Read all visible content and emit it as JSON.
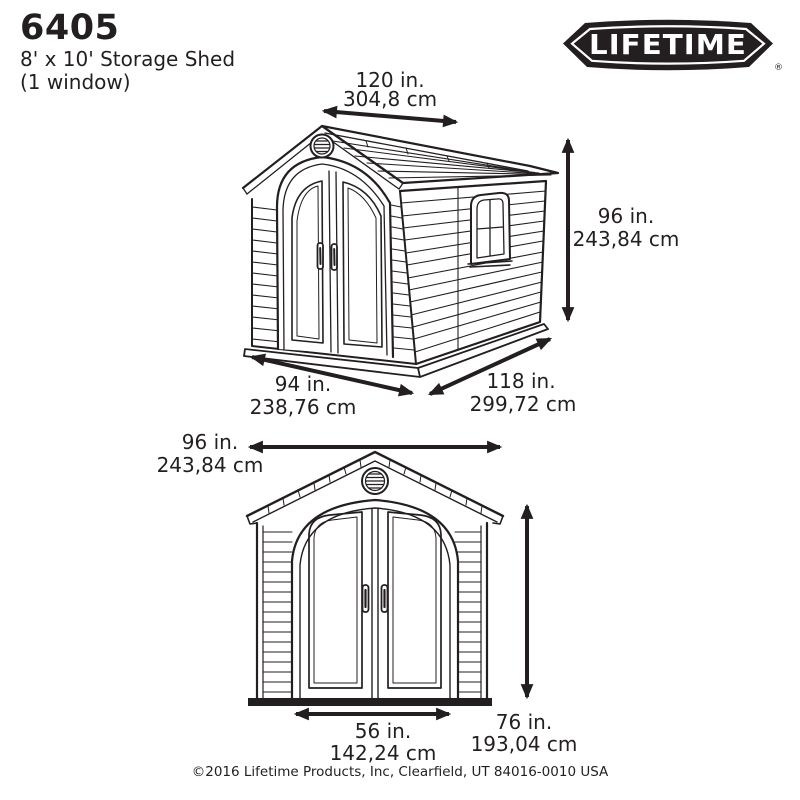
{
  "page": {
    "background": "#ffffff",
    "ink": "#231f20"
  },
  "header": {
    "model": "6405",
    "product": "8' x 10' Storage Shed",
    "variant": "(1 window)",
    "logo_text": "LIFETIME",
    "registered_mark": "®"
  },
  "diagrams": {
    "perspective": {
      "roof_width": {
        "in": "120 in.",
        "cm": "304,8 cm"
      },
      "height": {
        "in": "96 in.",
        "cm": "243,84 cm"
      },
      "front_width": {
        "in": "94 in.",
        "cm": "238,76 cm"
      },
      "depth": {
        "in": "118 in.",
        "cm": "299,72 cm"
      }
    },
    "front": {
      "width": {
        "in": "96 in.",
        "cm": "243,84 cm"
      },
      "height": {
        "in": "76 in.",
        "cm": "193,04 cm"
      },
      "door_width": {
        "in": "56 in.",
        "cm": "142,24 cm"
      }
    }
  },
  "footer": {
    "copyright": "©2016 Lifetime Products, Inc, Clearfield, UT 84016-0010 USA"
  }
}
